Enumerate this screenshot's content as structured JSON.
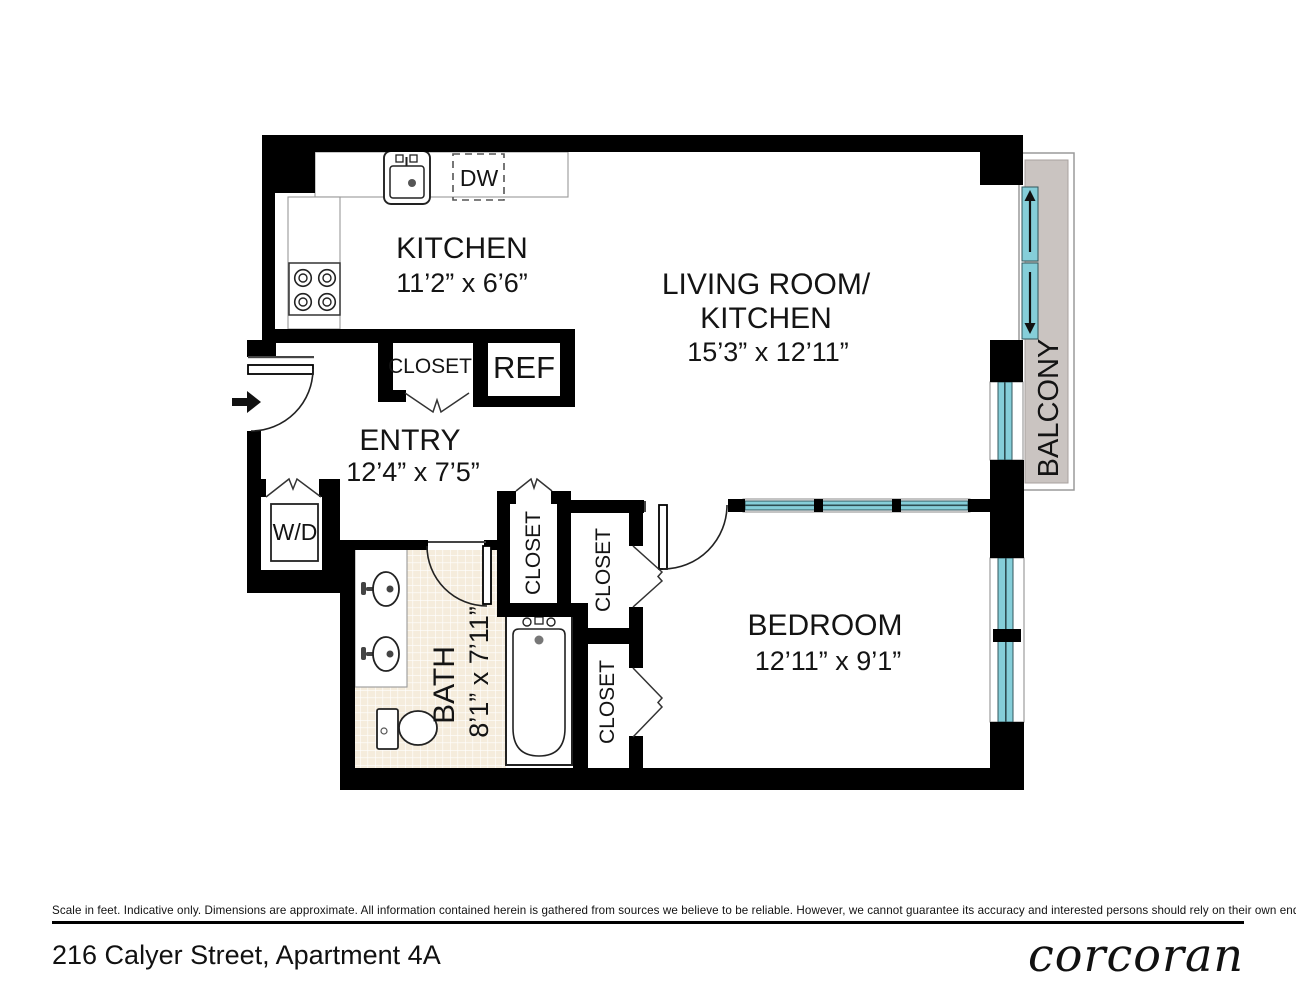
{
  "plan": {
    "rooms": {
      "kitchen": {
        "name": "KITCHEN",
        "dims": "11’2” x 6’6”"
      },
      "living": {
        "name_line1": "LIVING ROOM/",
        "name_line2": "KITCHEN",
        "dims": "15’3” x 12’11”"
      },
      "entry": {
        "name": "ENTRY",
        "dims": "12’4” x 7’5”"
      },
      "bedroom": {
        "name": "BEDROOM",
        "dims": "12’11” x 9’1”"
      },
      "bath": {
        "name": "BATH",
        "dims": "8’1” x 7’11”"
      },
      "balcony": {
        "name": "BALCONY"
      }
    },
    "fixtures": {
      "dishwasher": "DW",
      "refrigerator": "REF",
      "washer_dryer": "W/D",
      "closet_kitchen": "CLOSET",
      "closet_hall": "CLOSET",
      "closet_bedroom_upper": "CLOSET",
      "closet_bedroom_lower": "CLOSET"
    },
    "colors": {
      "wall": "#000000",
      "window": "#85ced9",
      "balcony_floor": "#cac4c1",
      "bath_tile": "#f5ecdc"
    }
  },
  "footer": {
    "disclaimer": "Scale in feet. Indicative only. Dimensions are approximate. All information contained herein is gathered from sources we believe to be reliable. However, we cannot guarantee its accuracy and interested persons should rely on their own enquiries.",
    "address": "216 Calyer Street, Apartment 4A",
    "brand": "corcoran"
  }
}
